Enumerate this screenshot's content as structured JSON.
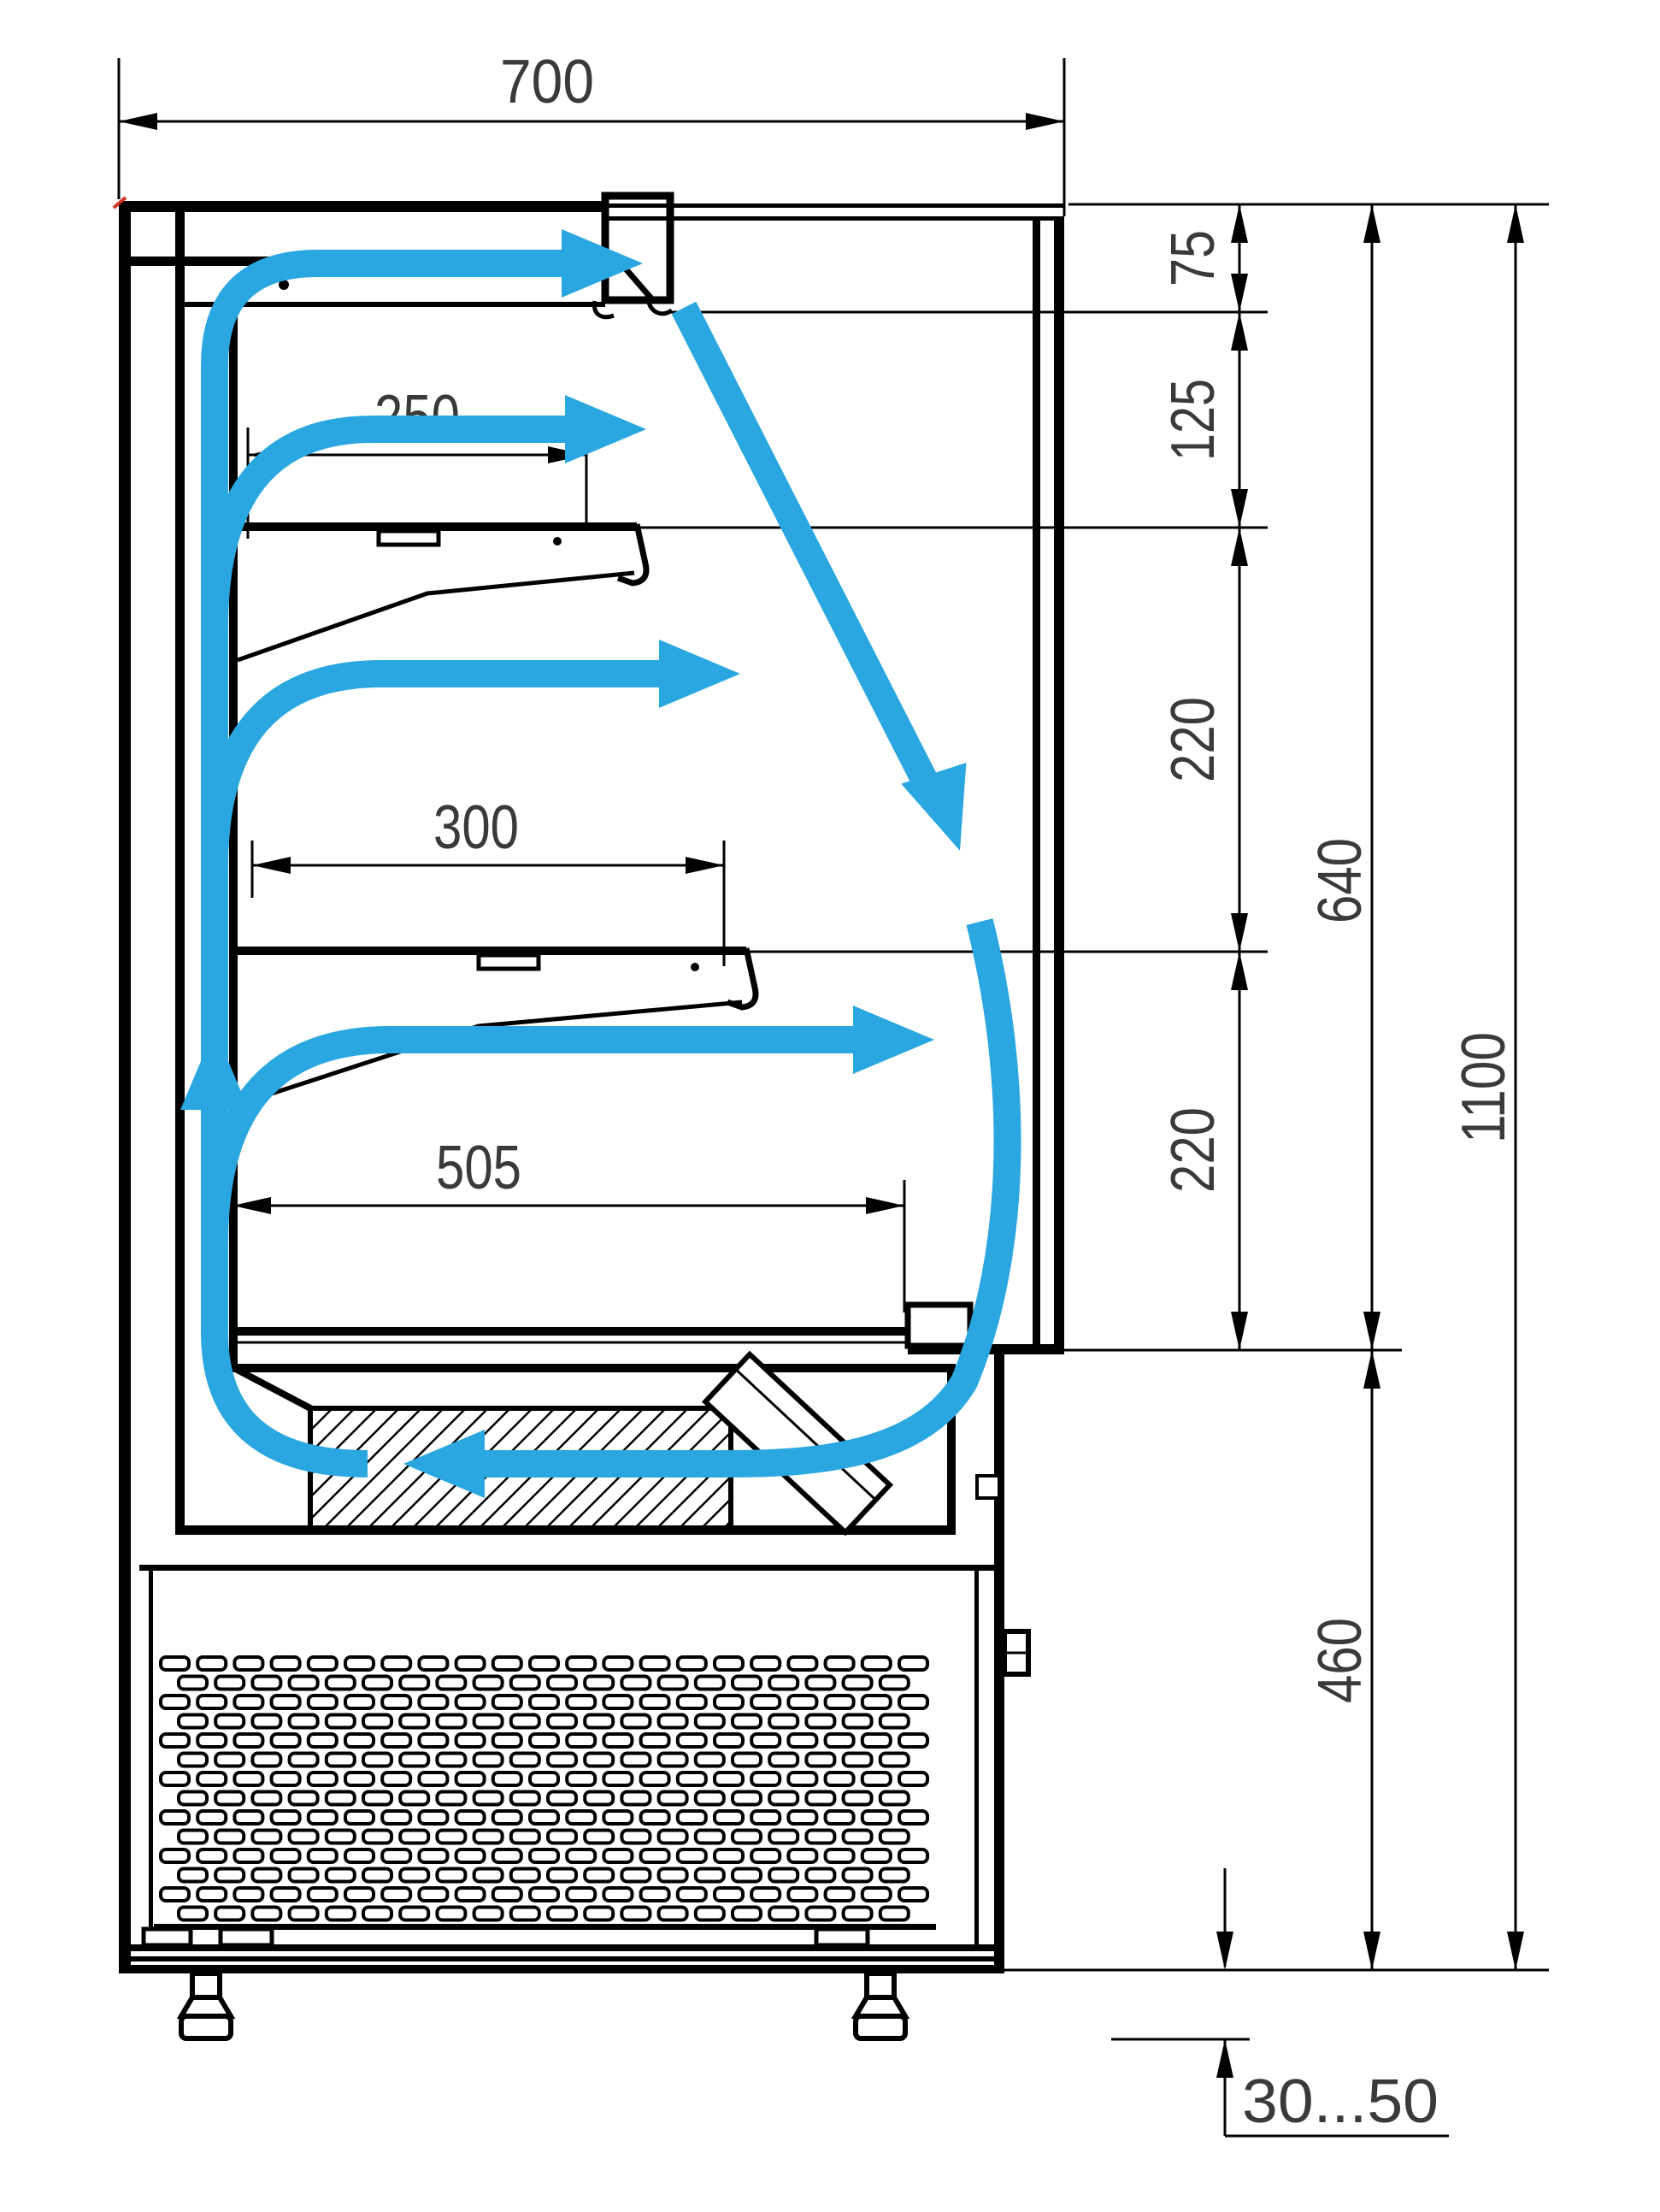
{
  "drawing": {
    "subject": "refrigerated-open-display-case-side-section-with-air-circulation",
    "units": "mm",
    "colors": {
      "outline": "#000000",
      "airflow": "#2AA7E0",
      "dimension_text": "#3A3A3A",
      "corner_tick": "#D03020",
      "background": "#FFFFFF"
    },
    "dimensions": {
      "overall_width": {
        "label": "700"
      },
      "top_shelf_depth": {
        "label": "250"
      },
      "middle_shelf_depth": {
        "label": "300"
      },
      "well_depth": {
        "label": "505"
      },
      "air_outlet_height": {
        "label": "75"
      },
      "outlet_to_top_shelf": {
        "label": "125"
      },
      "top_to_middle_shelf": {
        "label": "220"
      },
      "middle_shelf_to_well": {
        "label": "220"
      },
      "display_opening_height": {
        "label": "640"
      },
      "overall_height": {
        "label": "1100"
      },
      "base_height": {
        "label": "460"
      },
      "foot_clearance_range": {
        "label": "30...50"
      }
    }
  }
}
